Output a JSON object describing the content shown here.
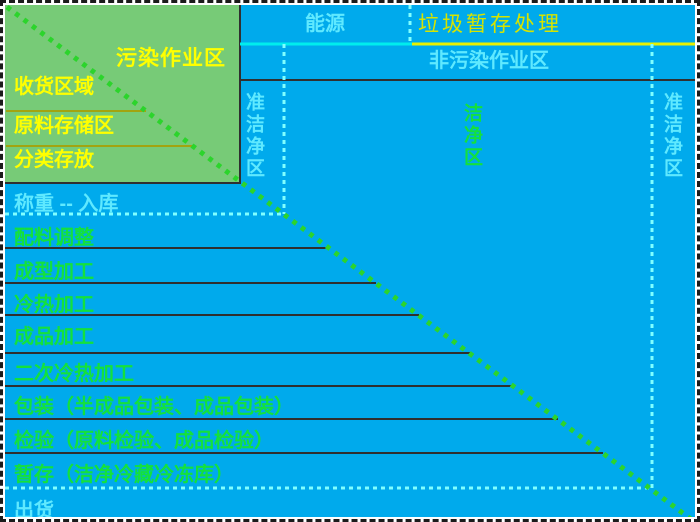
{
  "zones": {
    "pollution_zone": "污染作业区",
    "receiving_area": "收货区域",
    "raw_material_storage": "原料存储区",
    "sorted_storage": "分类存放",
    "energy": "能源",
    "garbage_temp_storage": "垃圾暂存处理",
    "non_pollution_zone": "非污染作业区",
    "quasi_clean_left": "准洁净区",
    "clean_zone": "洁净区",
    "quasi_clean_right": "准洁净区"
  },
  "process_rows": [
    {
      "label": "称重 -- 入库"
    },
    {
      "label": "配料调整"
    },
    {
      "label": "成型加工"
    },
    {
      "label": "冷热加工"
    },
    {
      "label": "成品加工"
    },
    {
      "label": "二次冷热加工"
    },
    {
      "label": "包装（半成品包装、成品包装）"
    },
    {
      "label": "检验（原料检验、成品检验）"
    },
    {
      "label": "暂存（洁净冷藏冷冻库）"
    },
    {
      "label": "出货"
    }
  ],
  "colors": {
    "background_blue": "#00aaec",
    "zone_green": "#77cb77",
    "diagonal_green": "#2cd42c",
    "text_yellow": "#ffff00",
    "text_pale_cyan": "#5fe9ff",
    "text_green": "#14e13c",
    "text_garbage_yellow": "#d6e400",
    "line_dark": "#303030",
    "line_olive": "#a2a410",
    "line_cyan": "#00eded",
    "line_yellow": "#e8f000",
    "line_dotted_cyan": "#80ffff"
  }
}
